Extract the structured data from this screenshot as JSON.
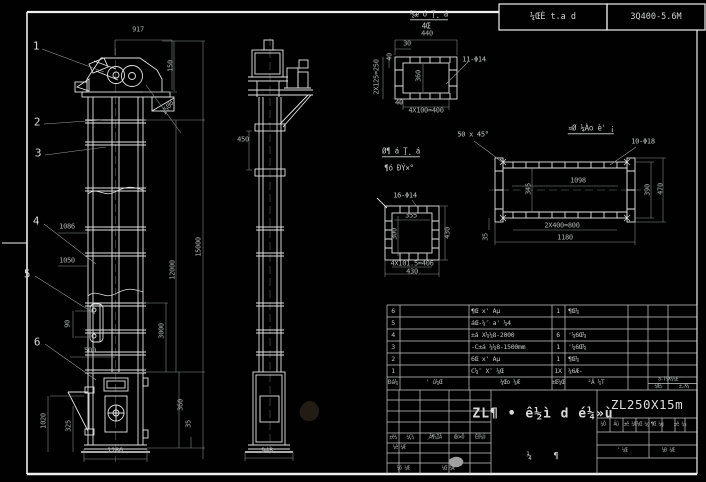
{
  "drawing": {
    "header": {
      "stamp_mid": "¼ŒÈ t.a d",
      "stamp_right": "3Q400-5.6M"
    },
    "balloons": [
      {
        "n": "1",
        "x": 36,
        "y": 46
      },
      {
        "n": "2",
        "x": 37,
        "y": 122
      },
      {
        "n": "3",
        "x": 38,
        "y": 153
      },
      {
        "n": "4",
        "x": 36,
        "y": 221
      },
      {
        "n": "5",
        "x": 27,
        "y": 274
      },
      {
        "n": "6",
        "x": 37,
        "y": 342
      }
    ],
    "annotations": [
      {
        "t": "917",
        "x": 138,
        "y": 30
      },
      {
        "t": "150",
        "x": 171,
        "y": 66,
        "r": -90
      },
      {
        "t": "1500",
        "x": 168,
        "y": 108,
        "r": -54
      },
      {
        "t": "1086",
        "x": 67,
        "y": 227
      },
      {
        "t": "1050",
        "x": 67,
        "y": 261
      },
      {
        "t": "90",
        "x": 68,
        "y": 324,
        "r": -90
      },
      {
        "t": "500",
        "x": 90,
        "y": 351
      },
      {
        "t": "1020",
        "x": 44,
        "y": 421,
        "r": -90
      },
      {
        "t": "325",
        "x": 69,
        "y": 426,
        "r": -90
      },
      {
        "t": "1286",
        "x": 115,
        "y": 451
      },
      {
        "t": "15000",
        "x": 199,
        "y": 247,
        "r": -90
      },
      {
        "t": "12000",
        "x": 173,
        "y": 270,
        "r": -90
      },
      {
        "t": "3000",
        "x": 162,
        "y": 331,
        "r": -90
      },
      {
        "t": "360",
        "x": 181,
        "y": 405,
        "r": -90
      },
      {
        "t": "35",
        "x": 189,
        "y": 424,
        "r": -90
      },
      {
        "t": "450",
        "x": 243,
        "y": 140
      },
      {
        "t": "948",
        "x": 267,
        "y": 451
      },
      {
        "t": "440",
        "x": 427,
        "y": 34
      },
      {
        "t": "30",
        "x": 407,
        "y": 44
      },
      {
        "t": "40",
        "x": 390,
        "y": 57,
        "r": -90
      },
      {
        "t": "2X125=250",
        "x": 377,
        "y": 77,
        "r": -90
      },
      {
        "t": "360",
        "x": 419,
        "y": 76,
        "r": -90
      },
      {
        "t": "11-Φ14",
        "x": 474,
        "y": 60,
        "cls": "note"
      },
      {
        "t": "40",
        "x": 399,
        "y": 103
      },
      {
        "t": "4X100=400",
        "x": 426,
        "y": 111
      },
      {
        "t": "50 x 45°",
        "x": 473,
        "y": 135,
        "cls": "note"
      },
      {
        "t": "10-Φ18",
        "x": 643,
        "y": 142,
        "cls": "note"
      },
      {
        "t": "1098",
        "x": 578,
        "y": 181
      },
      {
        "t": "345",
        "x": 529,
        "y": 189,
        "r": -90
      },
      {
        "t": "390",
        "x": 648,
        "y": 190,
        "r": -90
      },
      {
        "t": "470",
        "x": 661,
        "y": 189,
        "r": -90
      },
      {
        "t": "2X400=800",
        "x": 562,
        "y": 226
      },
      {
        "t": "1180",
        "x": 565,
        "y": 238
      },
      {
        "t": "35",
        "x": 486,
        "y": 237,
        "r": -90
      },
      {
        "t": "16-Φ14",
        "x": 405,
        "y": 196,
        "cls": "note"
      },
      {
        "t": "355",
        "x": 411,
        "y": 216
      },
      {
        "t": "300",
        "x": 395,
        "y": 234,
        "r": -90
      },
      {
        "t": "430",
        "x": 448,
        "y": 233,
        "r": -90
      },
      {
        "t": "4X101.5=406",
        "x": 412,
        "y": 264
      },
      {
        "t": "430",
        "x": 412,
        "y": 272
      },
      {
        "t": "½æ ó Ţ¸ á",
        "x": 429,
        "y": 15,
        "cls": "vtitle",
        "u": true
      },
      {
        "t": "4Œ",
        "x": 426,
        "y": 26,
        "cls": "vtitle"
      },
      {
        "t": "¤Ø ¼Ào è' ¡",
        "x": 591,
        "y": 129,
        "cls": "vtitle",
        "u": true
      },
      {
        "t": "Ø¶ á Ţ¸ á",
        "x": 401,
        "y": 152,
        "cls": "vtitle",
        "u": true
      },
      {
        "t": "¶ó ÐÝ×°",
        "x": 399,
        "y": 168,
        "cls": "vtitle"
      }
    ]
  },
  "bom": {
    "header": {
      "seq": "Ðá¼",
      "code": "' ú¼Œ",
      "name": "¼Œo ¼Æ",
      "qty": "±Œ¼Œ",
      "mat": "²Ä ¼T",
      "weight": "a-T¼X¼¼E",
      "weight_sub": "¼Œ¼",
      "remark": "±,X¼"
    },
    "rows": [
      {
        "no": "6",
        "code": "",
        "name": "¶Œ x' Aµ",
        "qty": "1",
        "mat": "¶Œ¼"
      },
      {
        "no": "5",
        "code": "",
        "name": "áŒ-¼″ a' ¼4",
        "qty": "",
        "mat": ""
      },
      {
        "no": "4",
        "code": "",
        "name": "±á X¼¼8-2000",
        "qty": "6",
        "mat": "'¼6Œ¼"
      },
      {
        "no": "3",
        "code": "",
        "name": "-C±á ¼¼8-1500mm",
        "qty": "1",
        "mat": "'¼6Œ¼"
      },
      {
        "no": "2",
        "code": "",
        "name": "6Œ x' Aµ",
        "qty": "1",
        "mat": "¶Œ¼"
      },
      {
        "no": "1",
        "code": "",
        "name": "C¼″ X″ ¼Œ",
        "qty": "1X",
        "mat": "¼6Æ-"
      }
    ]
  },
  "title_block": {
    "model": "ZL250X15m",
    "title": "ZL¶ • ê½ì d é¼»ù",
    "sheet_marks": [
      "¼",
      "¶"
    ],
    "rev_cols": [
      "±ê¼",
      "¼Ç¼",
      "¸Ä¶¼ÎÄ",
      "Œ©×Ö",
      "ÈÕ¼Ú"
    ],
    "design_label": "¼è ¼Æ",
    "extra_label": "¼ô ¼Œ",
    "craft_label": "¼Œ ¼Æ",
    "right_cols": [
      "¼Ö",
      "Ãü",
      "±ê ¼Œ",
      "¼Œ ¼g",
      "¶Œ ¼g",
      "±ê ¼¼"
    ],
    "right_row": [
      "' ¼Œ",
      "¼Ð ¼Œ"
    ]
  }
}
